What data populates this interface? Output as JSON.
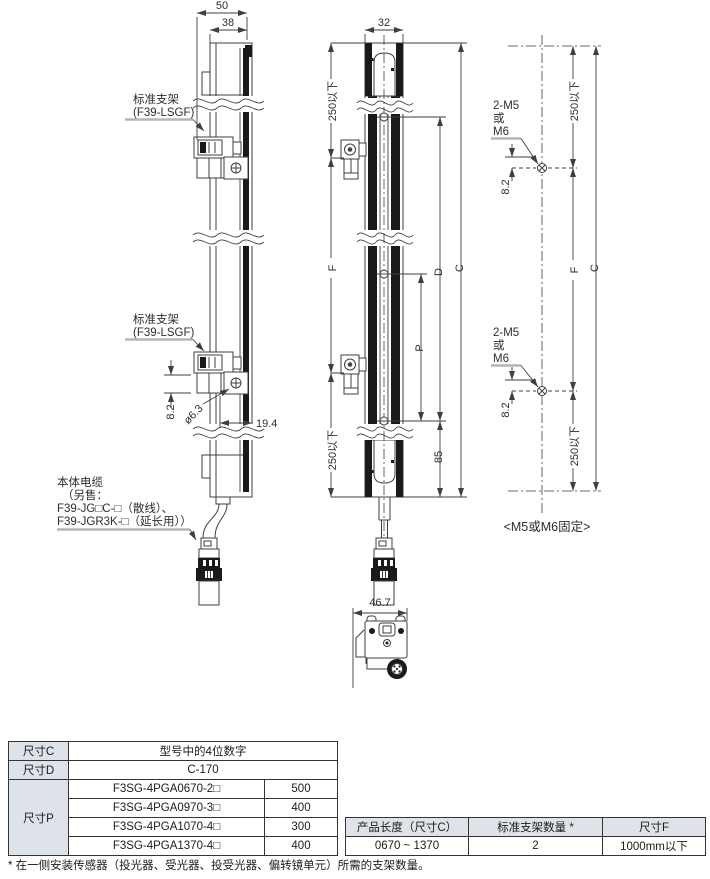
{
  "colors": {
    "line": "#3f3f3f",
    "text": "#2e2e2e",
    "leader_gray": "#b5b5b5",
    "table_header_bg": "#dde3e8",
    "solid_black": "#1a1a1a"
  },
  "drawing": {
    "side_view": {
      "dim_width_outer": "50",
      "dim_width_inner": "38",
      "bracket_label_top": {
        "line1": "标准支架",
        "line2": "(F39-LSGF)"
      },
      "bracket_label_bottom": {
        "line1": "标准支架",
        "line2": "(F39-LSGF)"
      },
      "dim_bracket_offset": "8.2",
      "dim_hole": "ø6.3",
      "dim_depth": "19.4",
      "cable_label": {
        "line1": "本体电缆",
        "line2": "（另售：",
        "line3": "F39-JG□C-□（散线）、",
        "line4": "F39-JGR3K-□（延长用））"
      }
    },
    "front_view": {
      "dim_width": "32",
      "dim_top_max": "250以下",
      "dim_f": "F",
      "dim_bottom_max": "250以下",
      "dim_c": "C",
      "dim_d": "D",
      "dim_p": "P",
      "dim_bottom_offset": "85"
    },
    "mount_view": {
      "screw_label_top": {
        "line1": "2-M5",
        "line2": "或",
        "line3": "M6"
      },
      "screw_label_bottom": {
        "line1": "2-M5",
        "line2": "或",
        "line3": "M6"
      },
      "dim_screw_offset_top": "8.2",
      "dim_screw_offset_bottom": "8.2",
      "dim_top_max": "250以下",
      "dim_f": "F",
      "dim_bottom_max": "250以下",
      "dim_c": "C",
      "caption": "<M5或M6固定>"
    },
    "bottom_view": {
      "dim_width": "46.7"
    }
  },
  "dimension_table": {
    "row_c": {
      "label": "尺寸C",
      "value": "型号中的4位数字"
    },
    "row_d": {
      "label": "尺寸D",
      "value": "C-170"
    },
    "row_p": {
      "label": "尺寸P",
      "models": [
        {
          "model": "F3SG-4PGA0670-2□",
          "value": "500"
        },
        {
          "model": "F3SG-4PGA0970-3□",
          "value": "400"
        },
        {
          "model": "F3SG-4PGA1070-4□",
          "value": "300"
        },
        {
          "model": "F3SG-4PGA1370-4□",
          "value": "400"
        }
      ]
    }
  },
  "bracket_table": {
    "headers": [
      "产品长度（尺寸C）",
      "标准支架数量 *",
      "尺寸F"
    ],
    "row": [
      "0670 ~ 1370",
      "2",
      "1000mm以下"
    ]
  },
  "footnote": "* 在一侧安装传感器（投光器、受光器、投受光器、偏转镜单元）所需的支架数量。"
}
